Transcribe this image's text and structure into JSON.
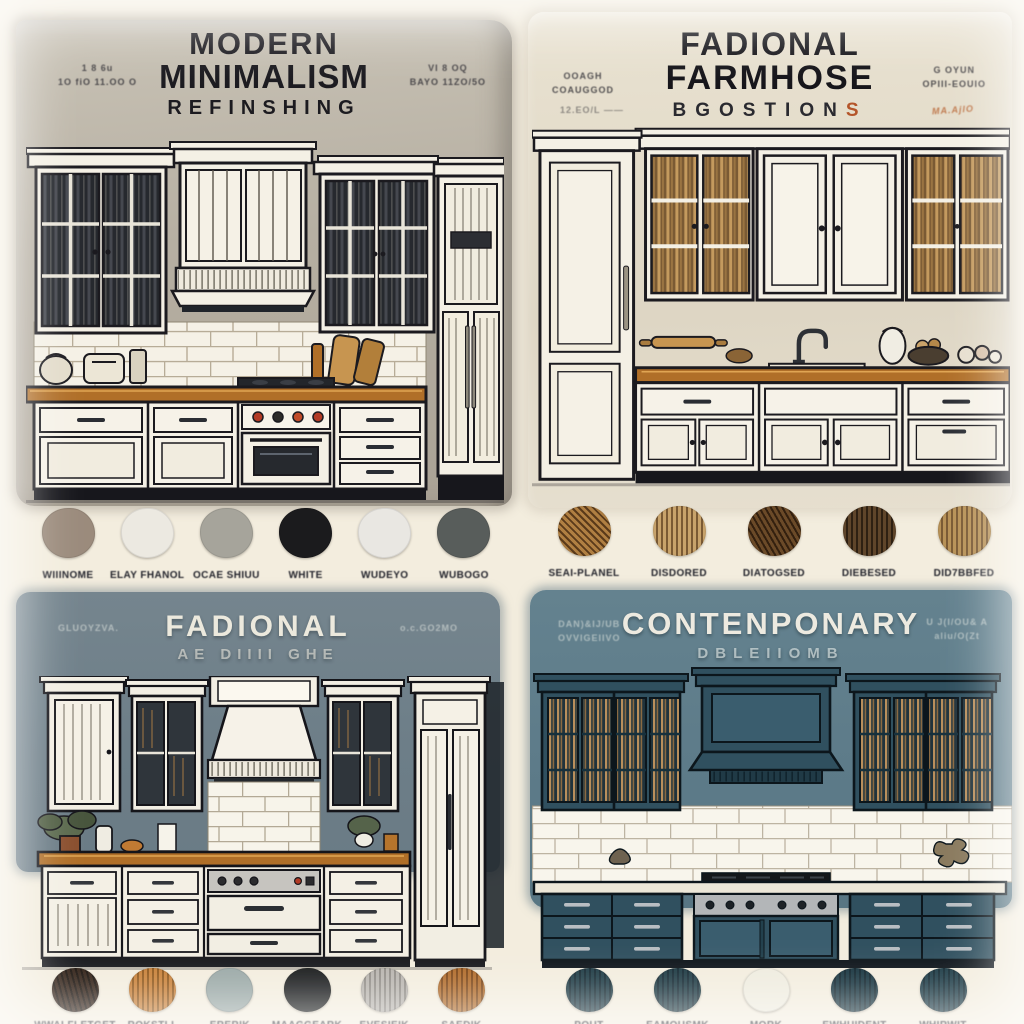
{
  "quadrants": {
    "modern": {
      "title1": "MODERN",
      "title2": "MINIMALISM",
      "subtitle": "REFINSHING",
      "note_left": "1 8 6u\n1O fiO 11.OO O",
      "note_right": "VI 8 OQ\nBAYO 11ZO/5O"
    },
    "farmhouse": {
      "title1": "FADIONAL",
      "title2": "FARMHOSE",
      "subtitle_main": "BGOSTION",
      "subtitle_accent": "S",
      "note_left": "OOAGH\nCOAUGGOD",
      "note_left2": "12.EO/L ——",
      "note_right": "G OYUN\nOPIII-EOUIO",
      "note_right2": "MA.AjlO"
    },
    "fadional": {
      "title1": "FADIONAL",
      "subtitle": "AE DIIII GHE",
      "note_left": "GLUOYZVA.",
      "note_right": "o.c.GO2MO"
    },
    "contemporary": {
      "title1": "CONTENPONARY",
      "subtitle": "DBLEIIOMB",
      "note_left": "DAN)&IJ/UB\nOVVIGEIIVO",
      "note_right": "U J(I/OU& A\naliu/O(Zt"
    }
  },
  "palettes": {
    "modern": [
      {
        "label": "WIIINOME",
        "color": "#9b8b7c"
      },
      {
        "label": "ELAY FHANOL",
        "color": "#ece9e1"
      },
      {
        "label": "OCAE SHIUU",
        "color": "#a6a49b"
      },
      {
        "label": "WHITE",
        "color": "#1b1b1d"
      },
      {
        "label": "WUDEYO",
        "color": "#e9e7e2"
      },
      {
        "label": "WUBOGO",
        "color": "#585d5b"
      }
    ],
    "farmhouse": [
      {
        "label": "SEAI-PLANEL",
        "color": "#b07f42",
        "stripe": "#5a3a1a",
        "angle": 45
      },
      {
        "label": "DISDORED",
        "color": "#c8a36b",
        "stripe": "#7a5a34",
        "angle": 90
      },
      {
        "label": "DIATOGSED",
        "color": "#6b4a28",
        "stripe": "#33200f",
        "angle": 60
      },
      {
        "label": "DIEBESED",
        "color": "#5f452a",
        "stripe": "#2e2012",
        "angle": 90
      },
      {
        "label": "DID7BBFED",
        "color": "#b89257",
        "stripe": "#7a5a34",
        "angle": 90
      }
    ],
    "fadional": [
      {
        "label": "WWALFLETGET",
        "color": "#2e1d12",
        "stripe": "#140c06",
        "angle": 75
      },
      {
        "label": "ROKSTLL",
        "color": "#c87f36",
        "stripe": "#8f5518",
        "angle": 90
      },
      {
        "label": "ERERIK",
        "color": "#9aa8a6"
      },
      {
        "label": "MAAGGEARK",
        "color": "#17191a"
      },
      {
        "label": "EVESIEIK",
        "color": "#b8b4ae",
        "stripe": "#908c86",
        "angle": 90
      },
      {
        "label": "SAEDIK",
        "color": "#b06a28",
        "stripe": "#7c4413",
        "angle": 90
      }
    ],
    "contemporary": [
      {
        "label": "POUT",
        "color": "#1d3a44",
        "stripe": "#122730",
        "angle": 90
      },
      {
        "label": "EAMOUSMK",
        "color": "#1c3942",
        "stripe": "#112630",
        "angle": 90
      },
      {
        "label": "MORK",
        "color": "#efecdf"
      },
      {
        "label": "EWHUIDENT",
        "color": "#16333e",
        "stripe": "#0d222b",
        "angle": 90
      },
      {
        "label": "WHIRWIT",
        "color": "#1b3a45",
        "stripe": "#102730",
        "angle": 90
      }
    ]
  },
  "colors": {
    "page_bg": "#f3edde",
    "panel_modern": "#b6afa2",
    "panel_farmhouse": "#ded6c4",
    "panel_fadional": "#6d7e88",
    "panel_contemporary": "#5d7b89",
    "accent_orange": "#b4552a",
    "counter_wood": "#b06f28",
    "navy_cabinet": "#30505f"
  }
}
